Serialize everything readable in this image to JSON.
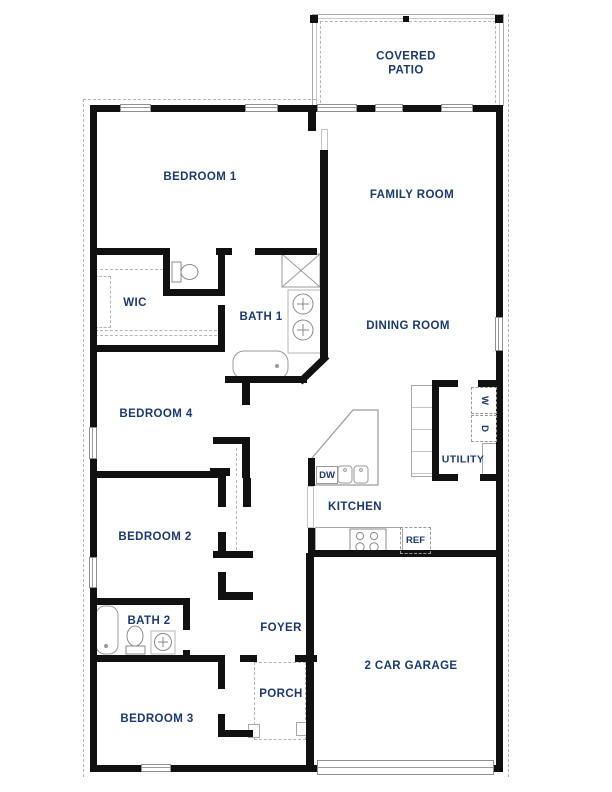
{
  "plan": {
    "type": "single-story residential floor plan",
    "palette": {
      "label_text": "#1b3a73",
      "walls": "#111111",
      "thin_lines": "#9a9a9a",
      "dashed_lines": "#b5b5b5",
      "background": "#ffffff"
    },
    "rooms": {
      "covered_patio": {
        "label": "COVERED PATIO"
      },
      "bedroom1": {
        "label": "BEDROOM 1"
      },
      "family_room": {
        "label": "FAMILY ROOM"
      },
      "wic": {
        "label": "WIC"
      },
      "bath1": {
        "label": "BATH 1"
      },
      "dining_room": {
        "label": "DINING ROOM"
      },
      "bedroom4": {
        "label": "BEDROOM 4"
      },
      "utility": {
        "label": "UTILITY"
      },
      "kitchen": {
        "label": "KITCHEN"
      },
      "bedroom2": {
        "label": "BEDROOM 2"
      },
      "bath2": {
        "label": "BATH 2"
      },
      "foyer": {
        "label": "FOYER"
      },
      "garage": {
        "label": "2 CAR GARAGE"
      },
      "porch": {
        "label": "PORCH"
      },
      "bedroom3": {
        "label": "BEDROOM 3"
      }
    },
    "appliances": {
      "washer": {
        "label": "W"
      },
      "dryer": {
        "label": "D"
      },
      "dishwasher": {
        "label": "DW"
      },
      "refrigerator": {
        "label": "REF"
      }
    }
  }
}
